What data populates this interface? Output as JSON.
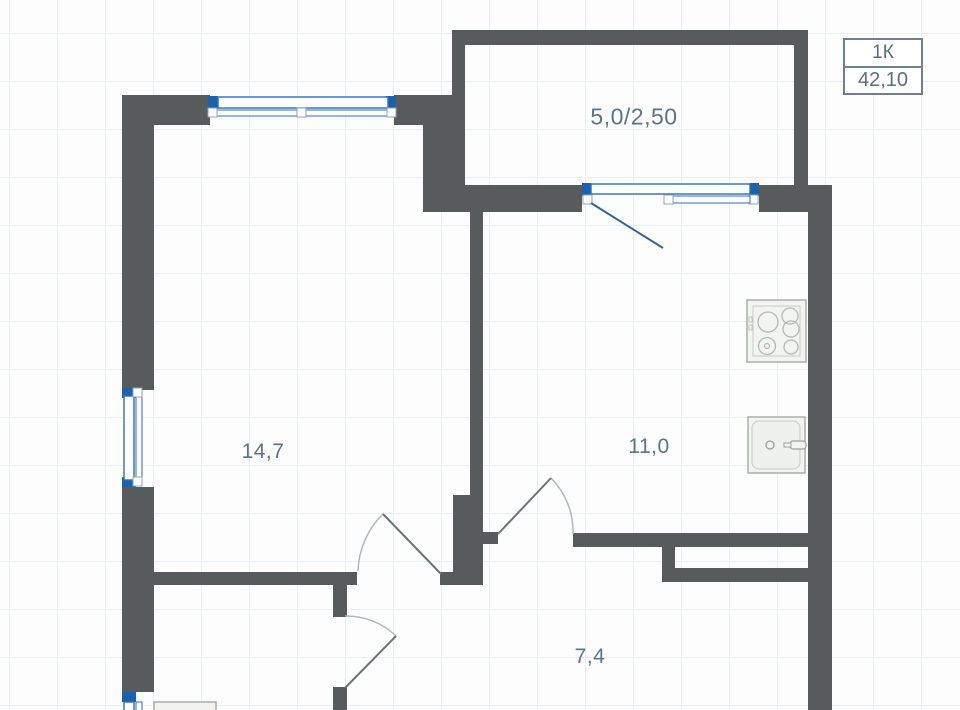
{
  "plan": {
    "legend": {
      "unit_label": "1К",
      "total_area": "42,10"
    },
    "rooms": [
      {
        "id": "balcony",
        "area_label": "5,0/2,50"
      },
      {
        "id": "living-room",
        "area_label": "14,7"
      },
      {
        "id": "kitchen",
        "area_label": "11,0"
      },
      {
        "id": "hallway",
        "area_label": "7,4"
      }
    ],
    "icons": [
      "stove-icon",
      "sink-icon",
      "washer-icon",
      "window-icon",
      "door-swing-icon"
    ],
    "colors": {
      "wall": "#585b5c",
      "window_frame_blue": "#2f6eb5",
      "window_jamb_blue": "#1d60ac",
      "balcony_door_leaf": "#35648f",
      "door_arc": "#b3b7ba",
      "door_leaf": "#6e7374",
      "label_text": "#5d7487",
      "legend_border": "#6e8090",
      "grid_line": "#e9eef3",
      "fixture_stroke": "#a9aeab",
      "fixture_fill": "#f3f4f1"
    }
  }
}
